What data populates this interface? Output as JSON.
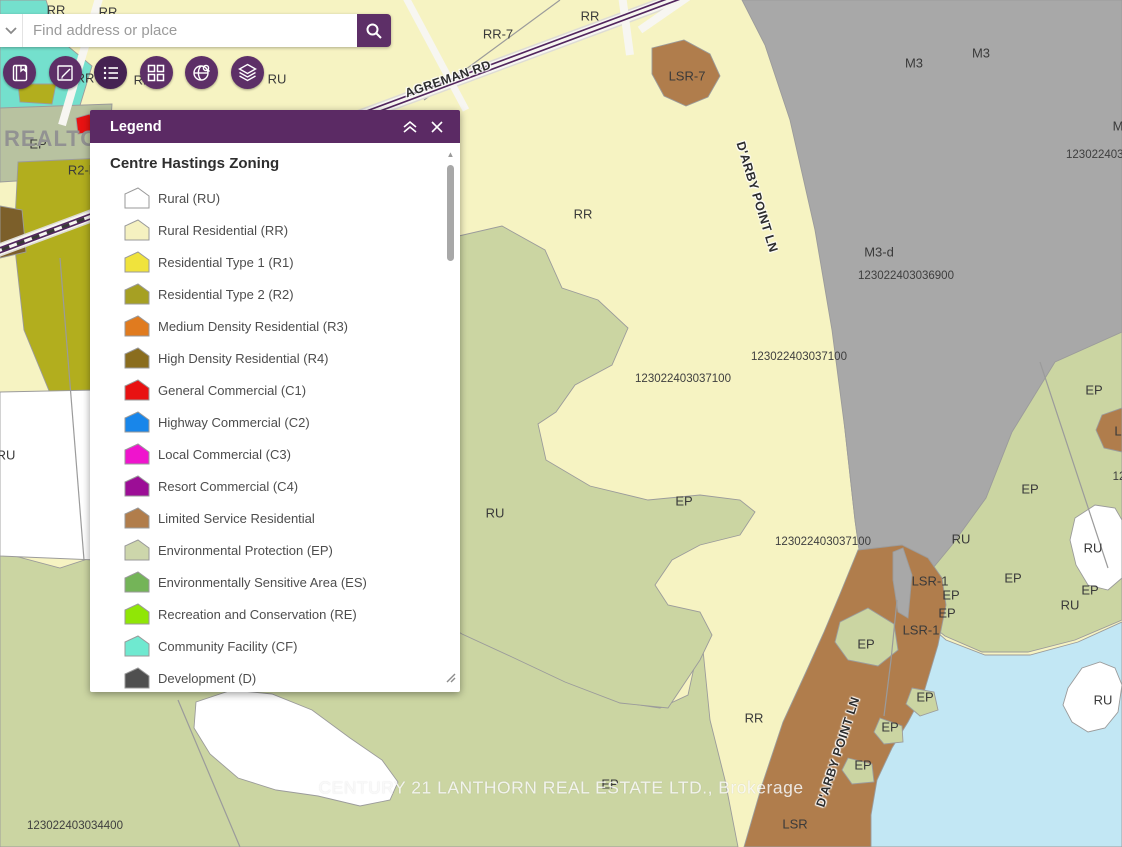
{
  "search": {
    "placeholder": "Find address or place"
  },
  "toolbar": {
    "buttons": [
      {
        "name": "bookmarks"
      },
      {
        "name": "basemap-sketch"
      },
      {
        "name": "legend",
        "active": true
      },
      {
        "name": "basemap-gallery"
      },
      {
        "name": "globe-search"
      },
      {
        "name": "layers"
      }
    ]
  },
  "legend_panel": {
    "title": "Legend",
    "heading": "Centre Hastings Zoning",
    "items": [
      {
        "label": "Rural (RU)",
        "color": "#ffffff"
      },
      {
        "label": "Rural Residential (RR)",
        "color": "#f5f1c0"
      },
      {
        "label": "Residential Type 1 (R1)",
        "color": "#f0e33c"
      },
      {
        "label": "Residential Type 2 (R2)",
        "color": "#a6a023"
      },
      {
        "label": "Medium Density Residential (R3)",
        "color": "#e07b1f"
      },
      {
        "label": "High Density Residential (R4)",
        "color": "#8a6d1e"
      },
      {
        "label": "General Commercial (C1)",
        "color": "#e81212"
      },
      {
        "label": "Highway Commercial (C2)",
        "color": "#1886ea"
      },
      {
        "label": "Local Commercial (C3)",
        "color": "#ef14cd"
      },
      {
        "label": "Resort Commercial (C4)",
        "color": "#9c0e96"
      },
      {
        "label": "Limited Service Residential",
        "color": "#b17d4b"
      },
      {
        "label": "Environmental Protection (EP)",
        "color": "#cdd6ab"
      },
      {
        "label": "Environmentally Sensitive Area (ES)",
        "color": "#74b458"
      },
      {
        "label": "Recreation and Conservation (RE)",
        "color": "#90e606"
      },
      {
        "label": "Community Facility (CF)",
        "color": "#6fe9d0"
      },
      {
        "label": "Development (D)",
        "color": "#4f4f4f"
      }
    ]
  },
  "map": {
    "colors": {
      "base": "#f6f3c2",
      "teal": "#74e0cd",
      "ep": "#cbd5a2",
      "ep_gray": "#b8c2a0",
      "olive": "#b2ae1e",
      "gray": "#a8a8a8",
      "brown": "#b07d4c",
      "brown_dark": "#7c5f2a",
      "water": "#c2e7f4",
      "white": "#ffffff",
      "red": "#e81212",
      "road": "#f7f6f1",
      "rail": "#52265e"
    },
    "labels": [
      {
        "text": "RR",
        "x": 56,
        "y": 10
      },
      {
        "text": "RR",
        "x": 108,
        "y": 12
      },
      {
        "text": "RR",
        "x": 85,
        "y": 78
      },
      {
        "text": "RR",
        "x": 143,
        "y": 80
      },
      {
        "text": "RU",
        "x": 277,
        "y": 79
      },
      {
        "text": "RR-7",
        "x": 498,
        "y": 34
      },
      {
        "text": "RR",
        "x": 590,
        "y": 16
      },
      {
        "text": "LSR-7",
        "x": 687,
        "y": 76
      },
      {
        "text": "M3",
        "x": 914,
        "y": 63
      },
      {
        "text": "M3",
        "x": 981,
        "y": 53
      },
      {
        "text": "M",
        "x": 1118,
        "y": 126
      },
      {
        "text": "1230224030",
        "x": 1098,
        "y": 155,
        "cls": "num"
      },
      {
        "text": "RR",
        "x": 583,
        "y": 214
      },
      {
        "text": "M3-d",
        "x": 879,
        "y": 252
      },
      {
        "text": "123022403036900",
        "x": 906,
        "y": 276,
        "cls": "num"
      },
      {
        "text": "123022403037100",
        "x": 799,
        "y": 357,
        "cls": "num"
      },
      {
        "text": "123022403037100",
        "x": 683,
        "y": 379,
        "cls": "num"
      },
      {
        "text": "EP",
        "x": 1094,
        "y": 390
      },
      {
        "text": "EP",
        "x": 38,
        "y": 144
      },
      {
        "text": "R2-h",
        "x": 82,
        "y": 170
      },
      {
        "text": "RU",
        "x": 6,
        "y": 455
      },
      {
        "text": "RU",
        "x": 495,
        "y": 513
      },
      {
        "text": "EP",
        "x": 684,
        "y": 501
      },
      {
        "text": "123022403037100",
        "x": 823,
        "y": 542,
        "cls": "num"
      },
      {
        "text": "RU",
        "x": 961,
        "y": 539
      },
      {
        "text": "EP",
        "x": 1030,
        "y": 489
      },
      {
        "text": "RU",
        "x": 1093,
        "y": 548
      },
      {
        "text": "LSR-1",
        "x": 930,
        "y": 581
      },
      {
        "text": "EP",
        "x": 951,
        "y": 595
      },
      {
        "text": "EP",
        "x": 1013,
        "y": 578
      },
      {
        "text": "EP",
        "x": 947,
        "y": 613
      },
      {
        "text": "EP",
        "x": 1090,
        "y": 590
      },
      {
        "text": "RU",
        "x": 1070,
        "y": 605
      },
      {
        "text": "LSR-1",
        "x": 921,
        "y": 630
      },
      {
        "text": "EP",
        "x": 866,
        "y": 644
      },
      {
        "text": "L",
        "x": 1118,
        "y": 431
      },
      {
        "text": "12",
        "x": 1119,
        "y": 477,
        "cls": "num"
      },
      {
        "text": "EP",
        "x": 925,
        "y": 697
      },
      {
        "text": "RR",
        "x": 754,
        "y": 718
      },
      {
        "text": "EP",
        "x": 890,
        "y": 727
      },
      {
        "text": "EP",
        "x": 863,
        "y": 765
      },
      {
        "text": "LSR",
        "x": 795,
        "y": 824
      },
      {
        "text": "RU",
        "x": 1103,
        "y": 700
      },
      {
        "text": "EP",
        "x": 610,
        "y": 784
      },
      {
        "text": "123022403034400",
        "x": 75,
        "y": 826,
        "cls": "num"
      },
      {
        "text": "AGREMAN RD",
        "x": 448,
        "y": 79,
        "rot": -19,
        "cls": "road"
      },
      {
        "text": "D'ARBY POINT LN",
        "x": 757,
        "y": 197,
        "rot": 73,
        "cls": "road"
      },
      {
        "text": "D'ARBY POINT LN",
        "x": 838,
        "y": 752,
        "rot": -72,
        "cls": "road"
      }
    ],
    "watermarks": {
      "realtor": "REALTOR",
      "brokerage": "CENTURY 21 LANTHORN REAL ESTATE LTD., Brokerage"
    }
  }
}
